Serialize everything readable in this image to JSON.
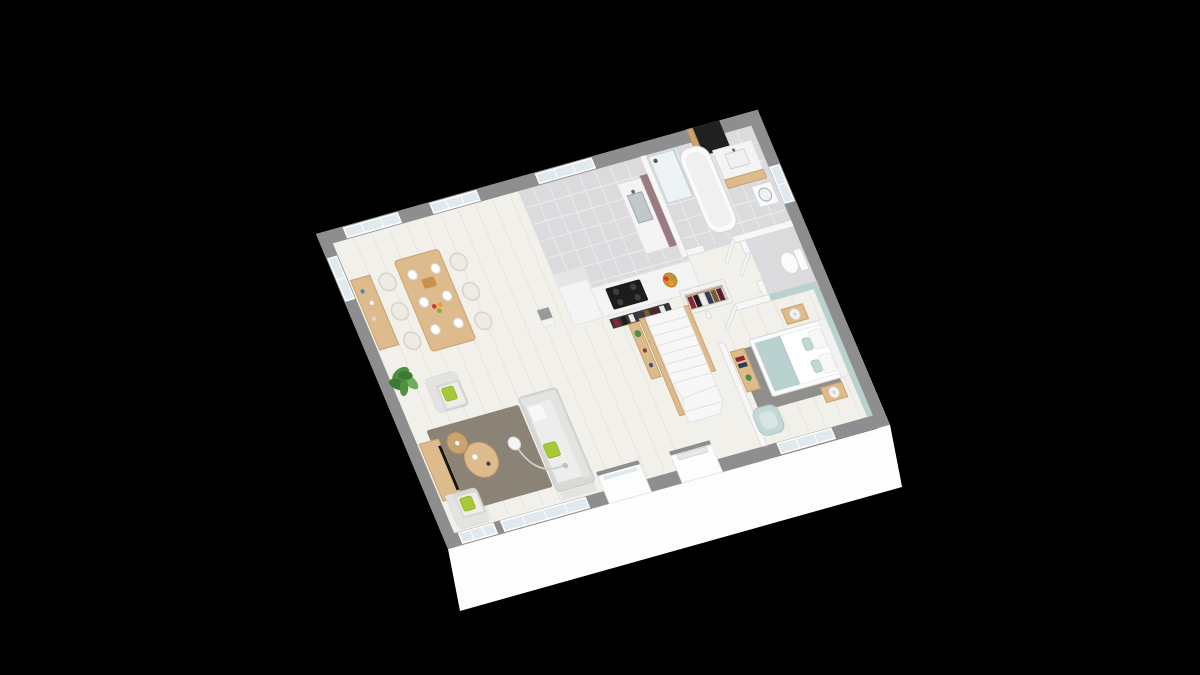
{
  "scene": {
    "description": "3D axonometric floor-plan render of a single-storey house interior, floating on a black background",
    "projection": "axonometric-top-down",
    "rooms": [
      {
        "name": "dining-area",
        "furniture": [
          "dining-table",
          "six-chairs",
          "place-settings",
          "sideboard",
          "potted-plant"
        ]
      },
      {
        "name": "kitchen",
        "furniture": [
          "l-shaped-counter",
          "cooktop",
          "sink",
          "mauve-splash-wall",
          "fruit-basket",
          "bottle-rack"
        ]
      },
      {
        "name": "bathroom",
        "furniture": [
          "bathtub",
          "shower",
          "vanity-sink",
          "washing-machine",
          "black-wardrobe-column"
        ]
      },
      {
        "name": "wc",
        "furniture": [
          "toilet"
        ]
      },
      {
        "name": "hallway",
        "furniture": [
          "open-closet-with-clothes",
          "structural-post"
        ]
      },
      {
        "name": "staircase",
        "furniture": [
          "white-winder-stairs",
          "wood-railings",
          "console-shelf"
        ]
      },
      {
        "name": "bedroom",
        "furniture": [
          "double-bed",
          "teal-throw",
          "nightstands",
          "bedside-lamps",
          "gray-rug",
          "teal-armchair",
          "wood-desk"
        ]
      },
      {
        "name": "living-room",
        "furniture": [
          "gray-sofa",
          "two-armchairs",
          "lime-cushions",
          "round-coffee-tables",
          "taupe-rug",
          "arc-floor-lamp",
          "tv-cabinet",
          "flat-tv"
        ]
      }
    ],
    "openings": [
      "north-dining-windows",
      "north-kitchen-window",
      "west-window",
      "south-corner-window",
      "south-bay-window",
      "entry-porch-recesses",
      "bedroom-south-window",
      "bathroom-east-window",
      "interior-doors"
    ]
  },
  "palette": {
    "background": "#000000",
    "facade_white": "#fdfdfd",
    "wall_exterior_top": "#8e8e8e",
    "wall_interior": "#f7f7f7",
    "wall_edge": "#d9d9d9",
    "floor_wood": "#f2f0ea",
    "floor_plank_line": "#e8e4dc",
    "floor_tile": "#dbdbdd",
    "tile_grout": "#ebebed",
    "rug_living": "#8b8376",
    "rug_bedroom": "#908f8b",
    "wood_light": "#ddbb8d",
    "wood_mid": "#caa36e",
    "sofa_gray": "#d8d8d6",
    "seat_light": "#ededeb",
    "cushion_white": "#f8f8f8",
    "accent_lime": "#a8c83a",
    "accent_teal": "#b9d2d0",
    "teal_soft": "#c2d8d4",
    "plant_green": "#4e8f42",
    "plant_green_dark": "#3c7a34",
    "plant_green_light": "#6fae58",
    "mauve_wall": "#9b7b82",
    "black_unit": "#202020",
    "cooktop_black": "#1c1c1c",
    "steel": "#c2c7ca",
    "glass": "#dfe9ee",
    "white_fixture": "#fbfbfb",
    "clothes": [
      "#8e2433",
      "#1c1c1c",
      "#ececec",
      "#343c55",
      "#7c5a33",
      "#5c1f28"
    ]
  }
}
